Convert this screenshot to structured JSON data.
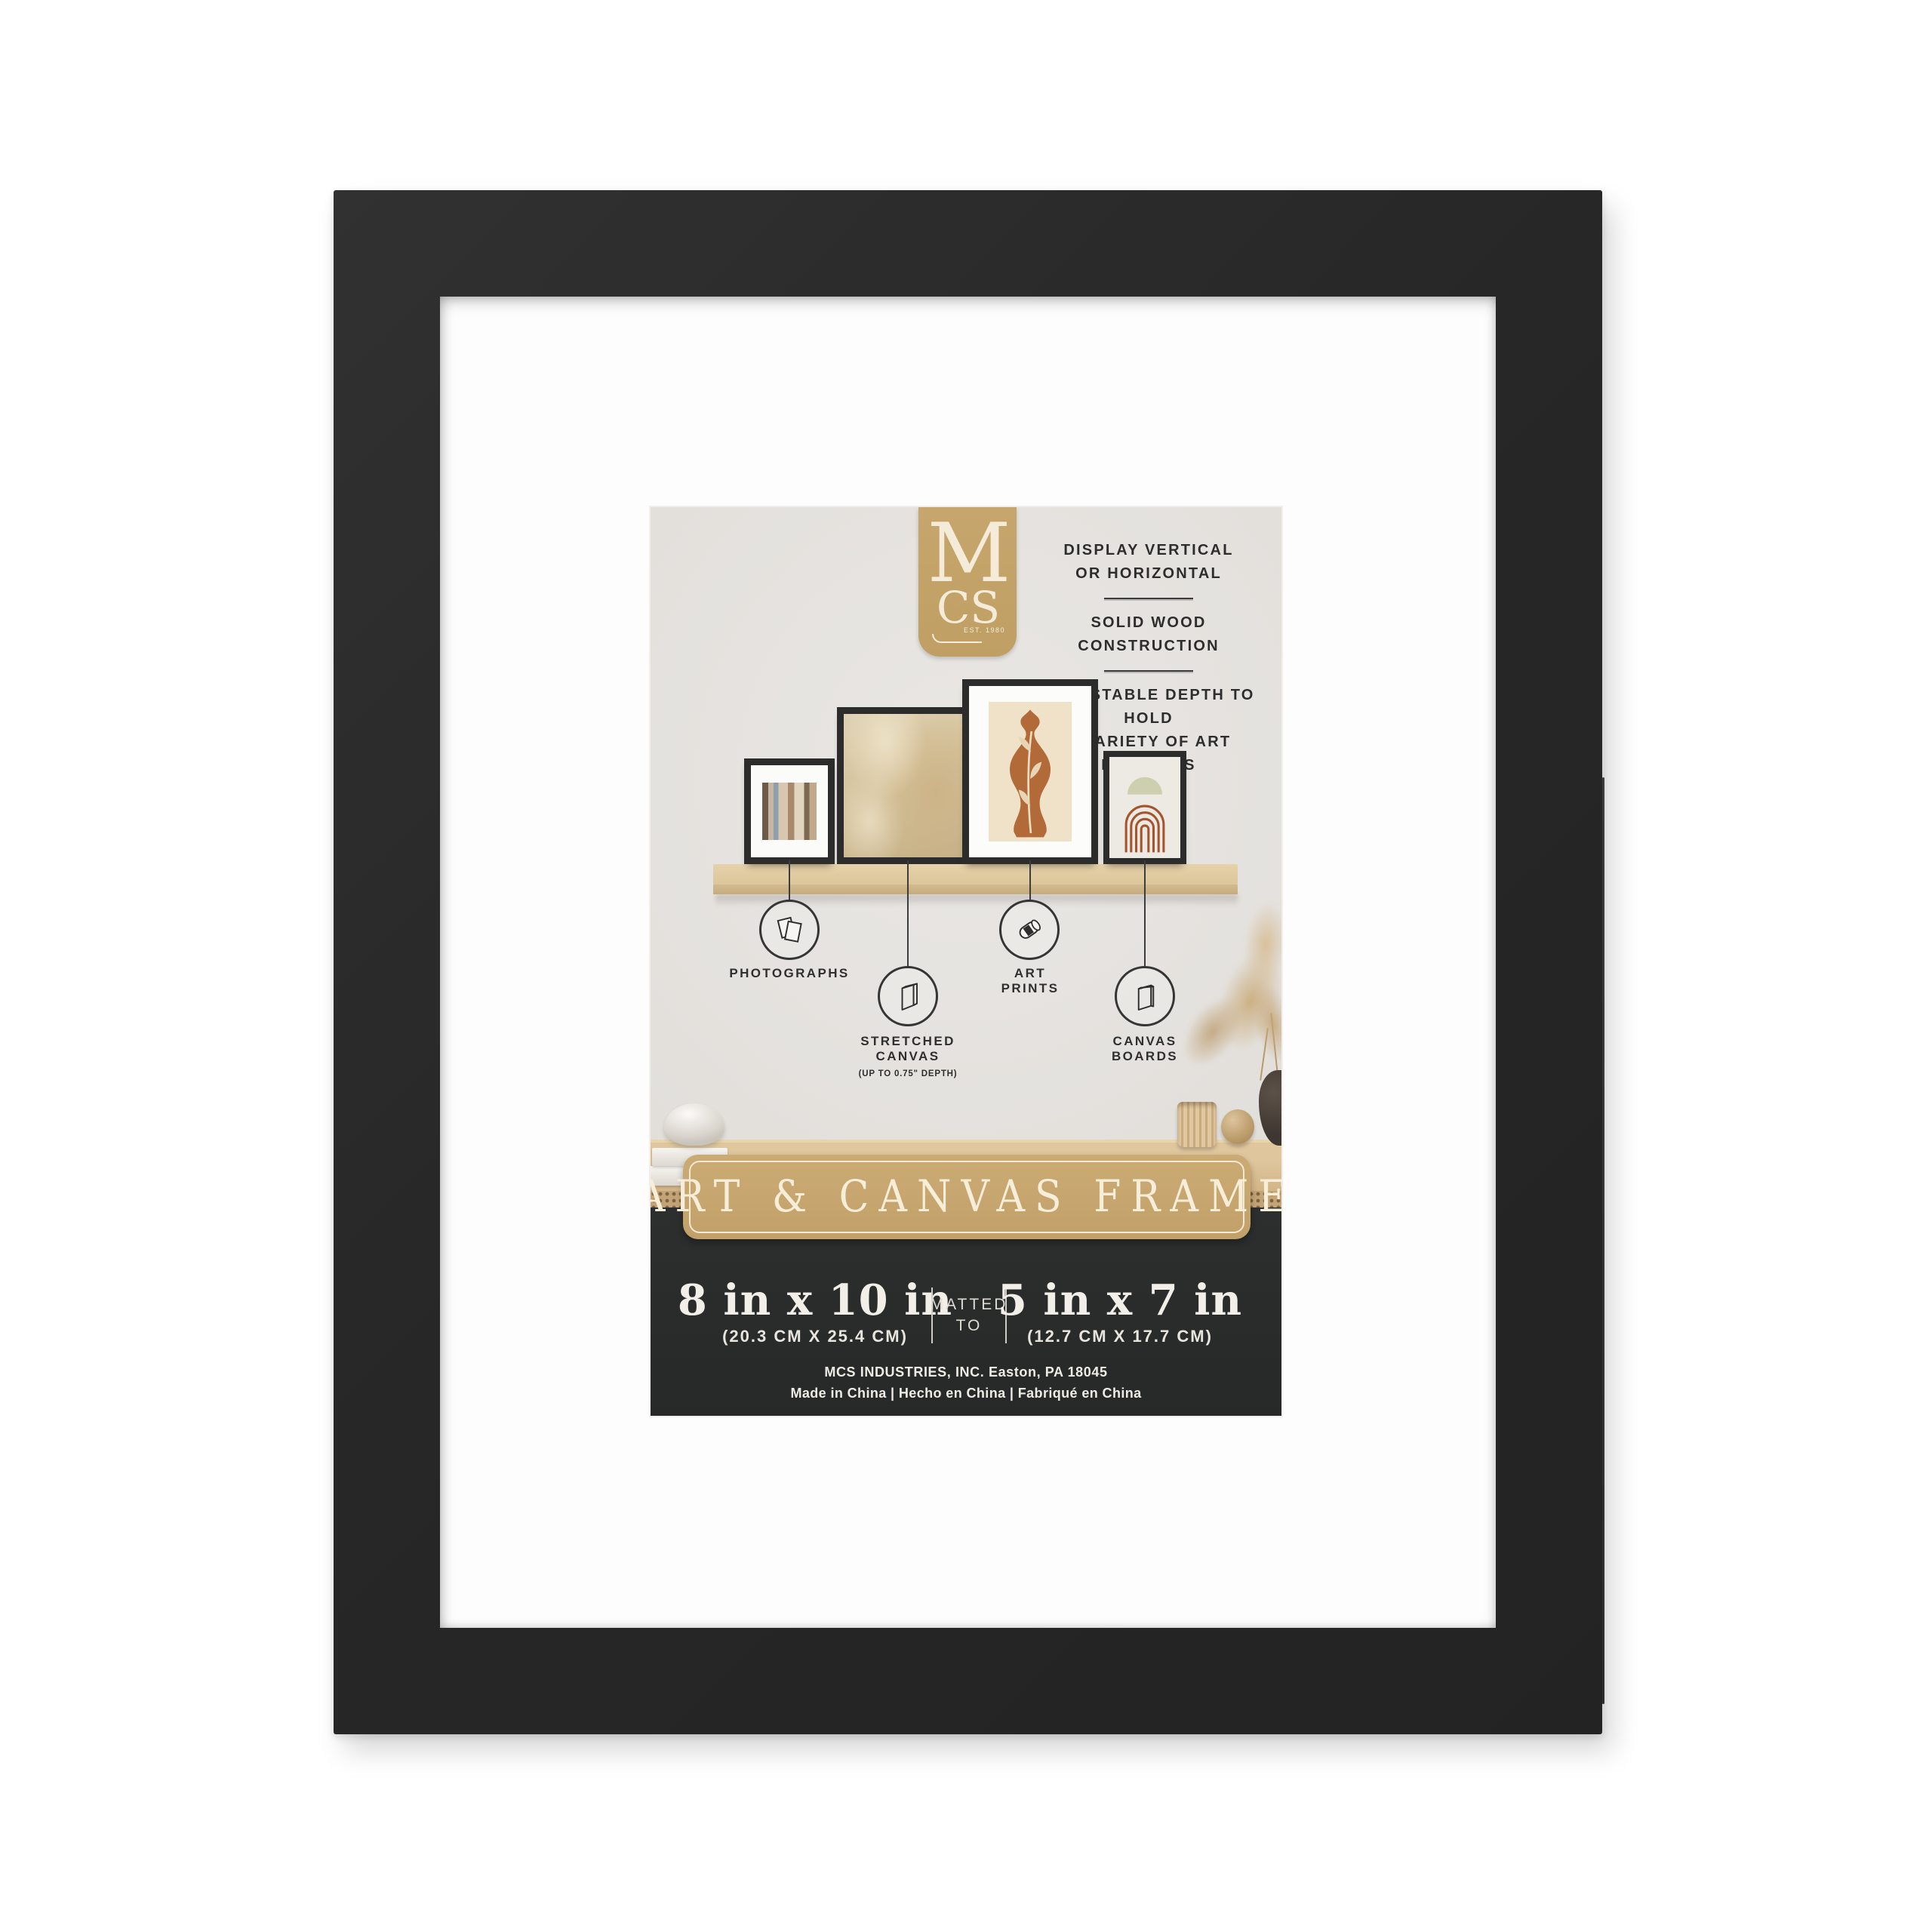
{
  "brand": {
    "m": "M",
    "cs": "CS",
    "est": "EST. 1980"
  },
  "features": {
    "f1a": "DISPLAY VERTICAL",
    "f1b": "OR HORIZONTAL",
    "f2a": "SOLID WOOD CONSTRUCTION",
    "f3a": "ADJUSTABLE DEPTH TO HOLD",
    "f3b": "A VARIETY OF ART PROJECTS"
  },
  "media_types": {
    "photographs": "PHOTOGRAPHS",
    "stretched1": "STRETCHED",
    "stretched2": "CANVAS",
    "stretched_sub": "(UP TO 0.75\" DEPTH)",
    "art1": "ART",
    "art2": "PRINTS",
    "boards1": "CANVAS",
    "boards2": "BOARDS"
  },
  "icons": {
    "photographs": "photographs-icon",
    "stretched_canvas": "stretched-canvas-icon",
    "art_prints": "art-prints-icon",
    "canvas_boards": "canvas-boards-icon"
  },
  "banner": {
    "title": "ART & CANVAS FRAME"
  },
  "sizes": {
    "outer_in": "8 in x 10 in",
    "outer_cm": "(20.3 CM X 25.4 CM)",
    "matted1": "MATTED",
    "matted2": "TO",
    "inner_in": "5 in x 7 in",
    "inner_cm": "(12.7 CM X 17.7 CM)"
  },
  "footer": {
    "line1": "MCS INDUSTRIES, INC. Easton, PA 18045",
    "line2": "Made in China | Hecho en China | Fabriqué en China"
  },
  "colors": {
    "frame_black": "#2a2a2a",
    "mat_white": "#fdfdfd",
    "wall_gray": "#e5e3e0",
    "gold": "#c5a46c",
    "cream": "#f5ecd7",
    "dark_panel": "#2b2d2c",
    "wood": "#ddc69e",
    "terracotta": "#b26a38",
    "sage": "#ccd0ae"
  }
}
